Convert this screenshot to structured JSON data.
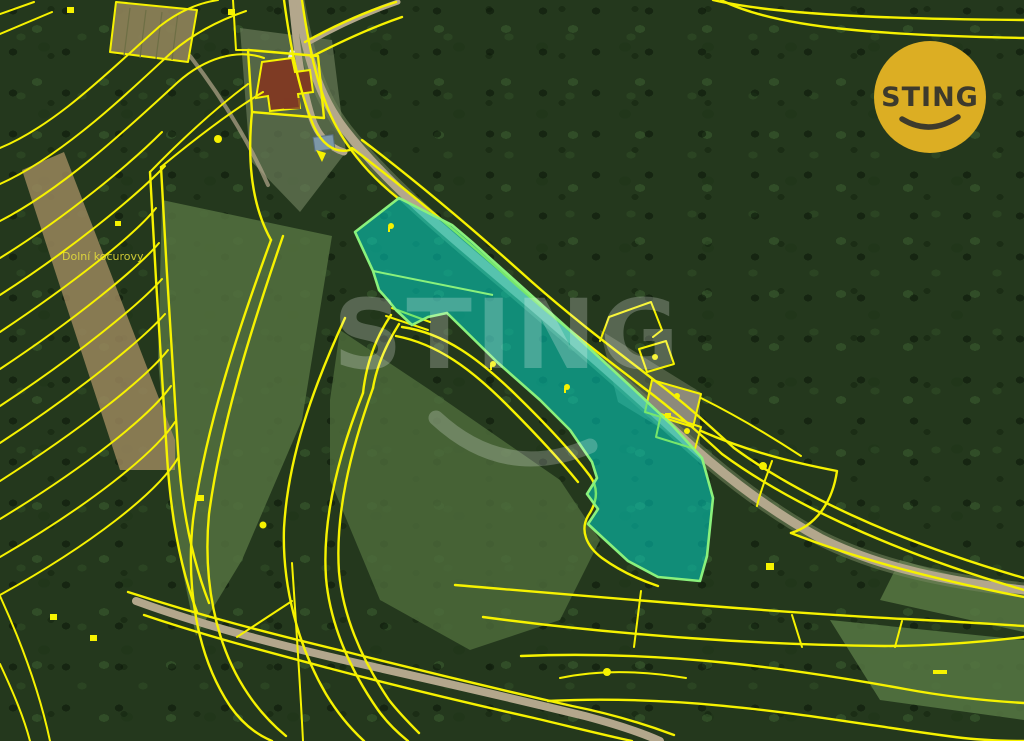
{
  "title": "Cadastral satellite map with highlighted parcel",
  "colors": {
    "line": "#f6f200",
    "hl_fill": "#00dccd",
    "hl_stroke": "#8af17c",
    "road": "#b3a78c",
    "wm": "#ffffff",
    "logo_bg": "#dcae23",
    "logo_text": "#3d3a2c",
    "label": "#e9e23b"
  },
  "map": {
    "place_label": "Dolní kocurovy",
    "highlighted_parcel": {
      "fill_opacity": 0.52
    }
  },
  "watermark": {
    "text": "STING"
  },
  "logo": {
    "text": "STING"
  }
}
